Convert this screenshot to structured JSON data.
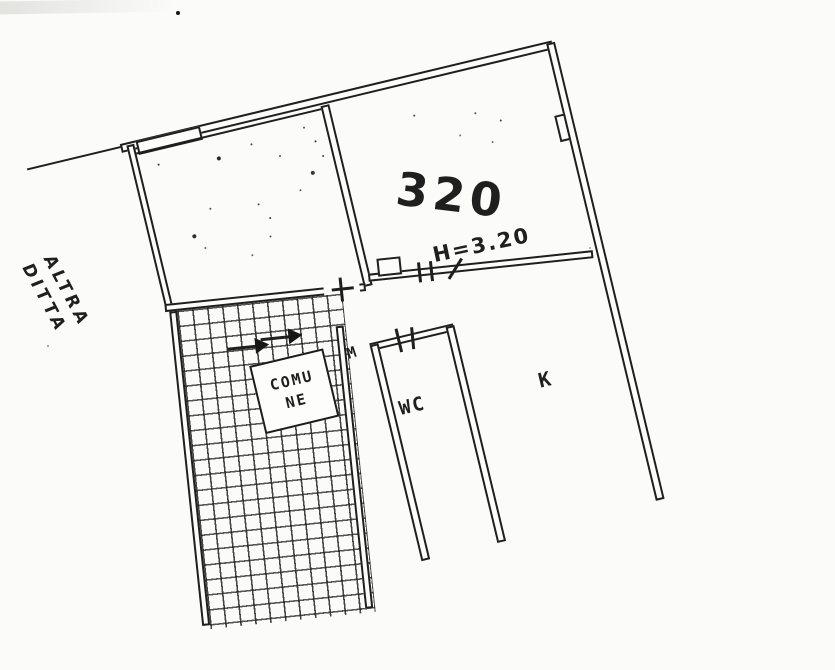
{
  "plan": {
    "colors": {
      "ink": "#1f1f1f",
      "paper": "#fbfbf9"
    },
    "outside_owner_label": {
      "line1": "ALTRA",
      "line2": "DITTA"
    },
    "room_320": {
      "number": "320",
      "height_note": "H=3.20"
    },
    "stairwell": {
      "comune_line1": "COMU",
      "comune_line2": "NE",
      "landing_mark": "M"
    },
    "wc": {
      "label": "WC"
    },
    "kitchen": {
      "label": "K"
    },
    "icons": {
      "stair_direction_arrow": "filled-right-triangle",
      "door_opening_tick": "short-cross-line",
      "door_swing_slash": "diagonal-stroke"
    }
  }
}
